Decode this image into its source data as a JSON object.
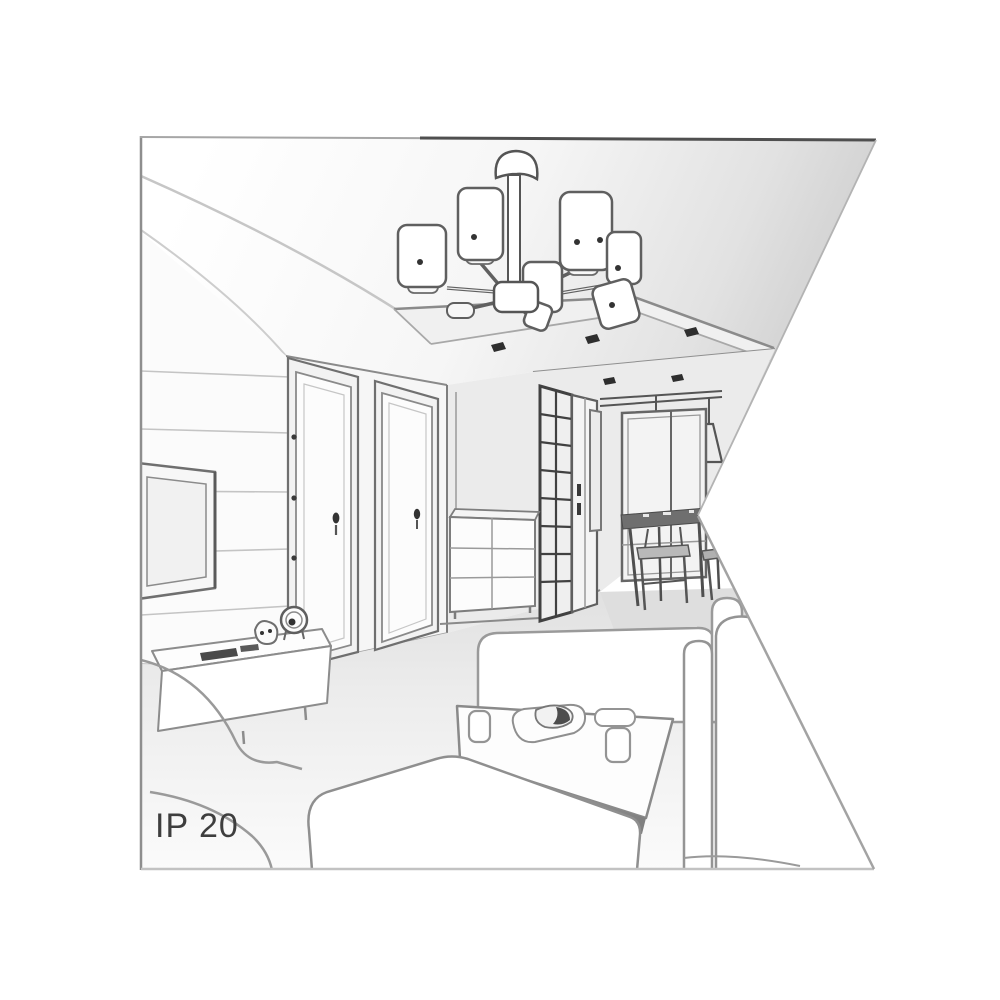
{
  "label": {
    "text": "IP 20"
  },
  "illustration": {
    "kind": "grayscale interior perspective line sketch (product ambience drawing for a ceiling luminaire)",
    "shape": "rectangular drawing with a triangular white notch cut into the right edge",
    "palette": {
      "background": "#ffffff",
      "main_line": "#5a5a5a",
      "soft_line": "#9a9a9a",
      "wall_fill": "#f5f5f5",
      "shadow_fill": "#e3e3e3",
      "dark_accent": "#2e2e2e",
      "label_color": "#3e3e3e"
    },
    "objects": [
      "ceiling chandelier with six cylindrical shades on radial arms",
      "recessed drop-ceiling with three spotlights",
      "two hallway ceiling spotlights",
      "wall-mounted TV on slatted panel wall",
      "low sideboard with remote controls, table clock and figurine",
      "two interior doors with handles and hinges",
      "grid-front wardrobe",
      "white chest of drawers",
      "dining nook with window, two cone pendant lamps, table and chairs",
      "far two-seater sofa",
      "right sofa with armrests",
      "left sofa",
      "large foreground sofa",
      "coffee table with two cups, a serving plate with pastry and a tray"
    ]
  }
}
